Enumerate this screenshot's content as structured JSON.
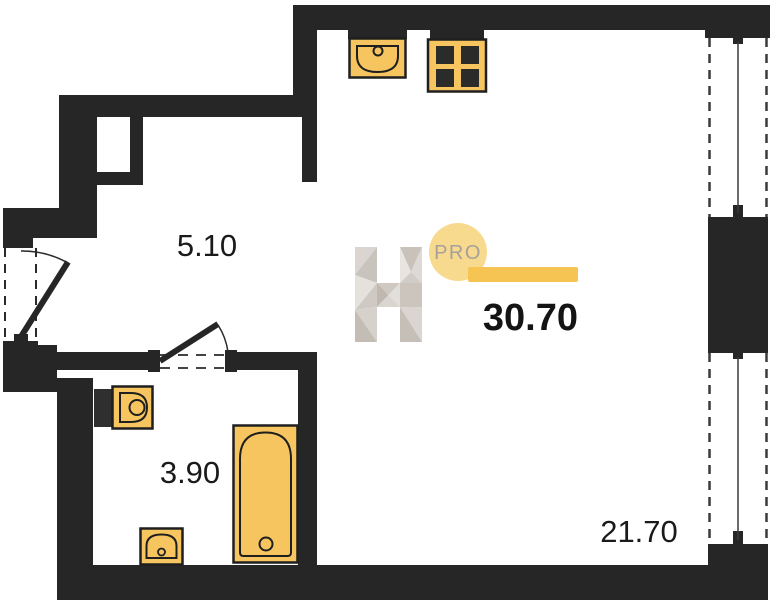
{
  "floor_plan": {
    "brand": {
      "letter_logo": "H",
      "badge_label": "PRO"
    },
    "total_area_label": "30.70",
    "rooms": [
      {
        "id": "hallway",
        "area_label": "5.10"
      },
      {
        "id": "bathroom",
        "area_label": "3.90"
      },
      {
        "id": "living-room",
        "area_label": "21.70"
      }
    ],
    "fixtures": [
      "kitchen-sink",
      "stove",
      "toilet",
      "washbasin",
      "bathtub",
      "window-upper",
      "window-lower",
      "entrance-door",
      "bathroom-door"
    ],
    "colors": {
      "wall": "#262626",
      "fixture_fill": "#f7c55f",
      "fixture_stroke": "#1f1f1f",
      "burner": "#2b2b29",
      "accent_bar": "#f6c452",
      "badge_circle": "#f8da8e",
      "badge_text": "#a5a09a",
      "label_text": "#1a1a1a",
      "logo_gray_light": "#e7e4e0",
      "logo_gray_mid": "#d6d1cb",
      "logo_gray_dark": "#c3bdb6"
    }
  }
}
